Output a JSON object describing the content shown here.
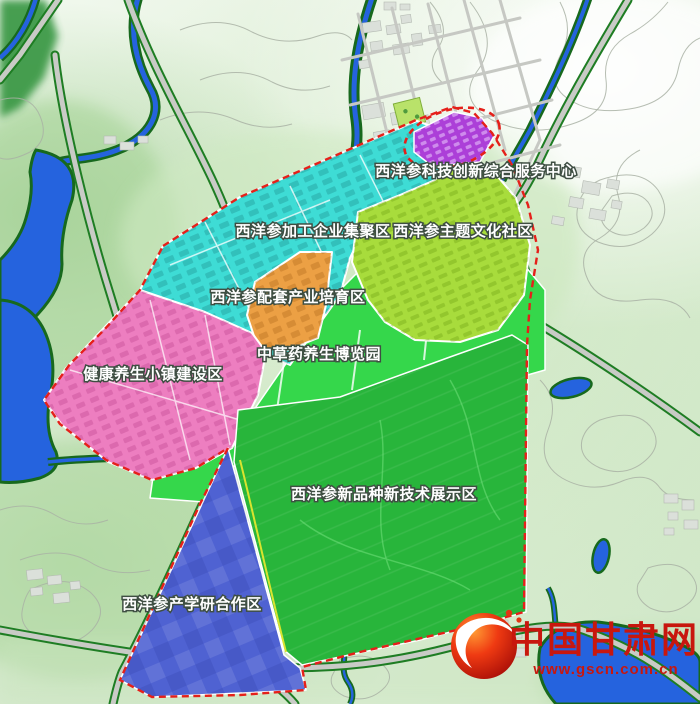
{
  "map_title": "西洋参产业规划图",
  "zones": [
    {
      "id": "tech-innovation-service-center",
      "label": "西洋参科技创新综合服务中心",
      "color": "#ac3fd8"
    },
    {
      "id": "processing-enterprise-cluster",
      "label": "西洋参加工企业集聚区",
      "color": "#3edcd5"
    },
    {
      "id": "theme-culture-community",
      "label": "西洋参主题文化社区",
      "color": "#a8dc3c"
    },
    {
      "id": "supporting-industry-cultivation",
      "label": "西洋参配套产业培育区",
      "color": "#eca044"
    },
    {
      "id": "herbal-wellness-expo-park",
      "label": "中草药养生博览园",
      "color": "#35d74b"
    },
    {
      "id": "health-wellness-town",
      "label": "健康养生小镇建设区",
      "color": "#ed7ec0"
    },
    {
      "id": "new-variety-tech-display",
      "label": "西洋参新品种新技术展示区",
      "color": "#28b53b"
    },
    {
      "id": "industry-university-research",
      "label": "西洋参产学研合作区",
      "color": "#4f62d2"
    }
  ],
  "watermark": {
    "site_name": "中国甘肃网",
    "site_url": "www.gscn.com.cn",
    "brand_color": "#c8170e"
  },
  "colors": {
    "water": "#2563de",
    "river_bank": "#17691d",
    "road_fill": "#c9cbc6",
    "road_edge": "#1e7d23",
    "planning_boundary": "#e5201a",
    "contour": "#a9b2a5"
  }
}
